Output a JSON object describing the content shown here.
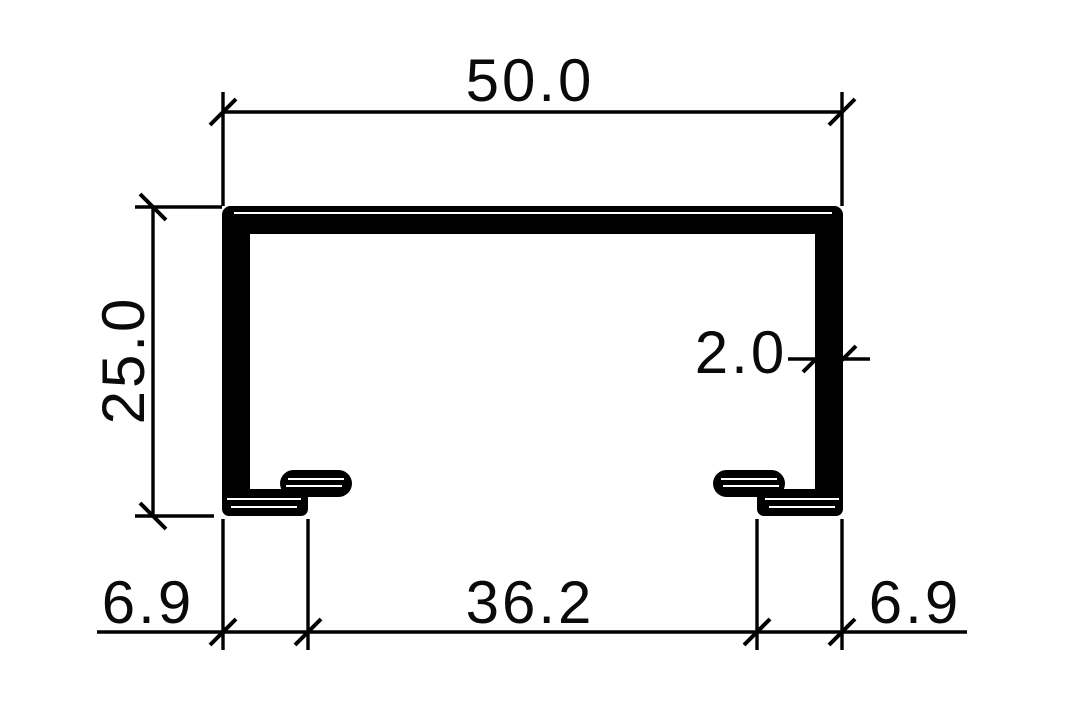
{
  "drawing": {
    "background_color": "#ffffff",
    "line_color": "#000000",
    "profile": {
      "type": "c-channel-cross-section",
      "fill_color": "#000000"
    },
    "dimensions": {
      "width": "50.0",
      "height": "25.0",
      "wall_thickness": "2.0",
      "bottom_left_flange": "6.9",
      "bottom_opening": "36.2",
      "bottom_right_flange": "6.9"
    },
    "dimension_values": {
      "width": 50.0,
      "height": 25.0,
      "wall_thickness": 2.0,
      "bottom_left_flange": 6.9,
      "bottom_opening": 36.2,
      "bottom_right_flange": 6.9
    }
  }
}
